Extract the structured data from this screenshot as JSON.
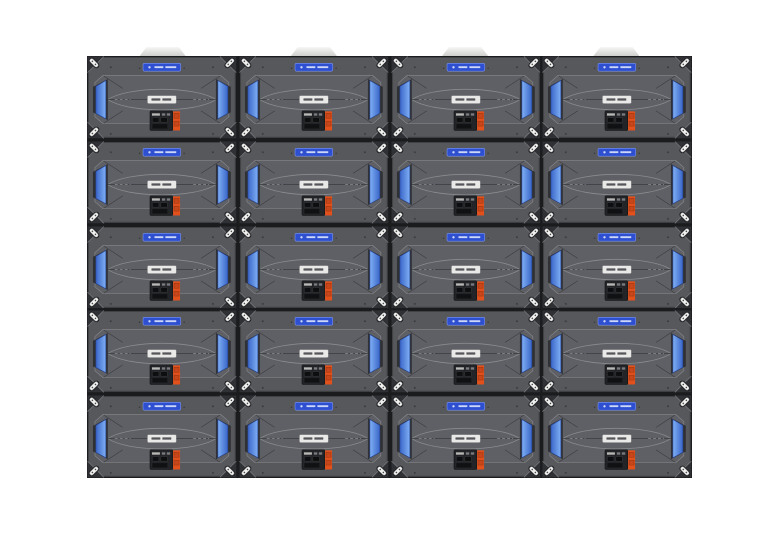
{
  "scene": {
    "title": "LED video wall cabinets, rear view",
    "background_color": "#ffffff"
  },
  "wall": {
    "columns": 4,
    "rows": 5,
    "panel_count": 20,
    "hanging_bracket_count": 4
  },
  "panel_parts": [
    "status-badge-blue",
    "model-label-white",
    "power-supply-module",
    "orange-warning-strip",
    "blue-side-handle-left",
    "blue-side-handle-right",
    "corner-quick-lock-latches",
    "corner-screws",
    "center-seam-line",
    "lens-shaped-rib-pattern"
  ],
  "colors": {
    "panel_body": "#57585c",
    "panel_body_light": "#5f6065",
    "panel_edge_dark": "#303135",
    "seam": "#1b1c1e",
    "line_light": "#8a8b8f",
    "line_dark": "#3a3b3e",
    "handle_blue": "#3a66c8",
    "handle_blue_light": "#7fb0f5",
    "handle_blue_dark": "#26469a",
    "badge_blue": "#2d4fd0",
    "badge_border": "#7e96ea",
    "label_white": "#e9e9e7",
    "power_box": "#232427",
    "orange": "#e2511c",
    "latch_white": "#f0f0ee",
    "tab_light": "#e4e4e2",
    "screw_dark": "#3b3c3f"
  }
}
